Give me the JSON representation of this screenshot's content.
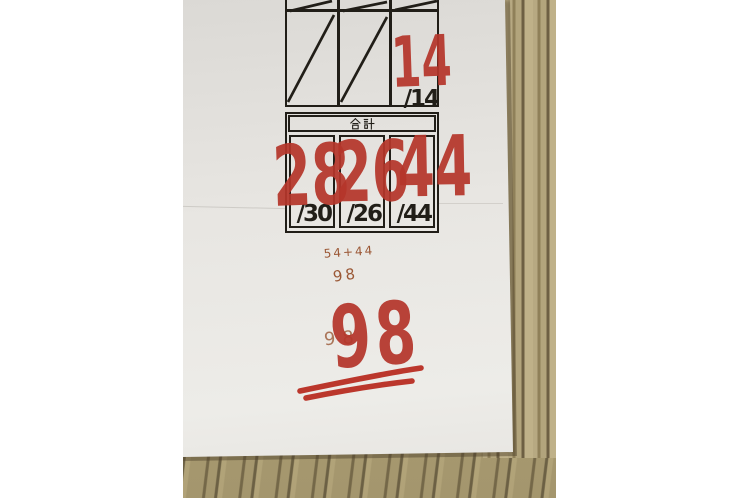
{
  "scene": {
    "description": "Photograph of a graded paper score sheet lying on a wooden desk, white margins left and right",
    "background": "#ffffff"
  },
  "colors": {
    "ink": "#211e18",
    "marker": "#b5362b",
    "pen": "#9b5836",
    "paper": "#e8e6e2",
    "wood": "#b2a37c"
  },
  "table": {
    "header_label": "合計",
    "cutoff_row": {
      "cells": [
        {
          "mark": "diagonal-slash"
        },
        {
          "mark": "diagonal-slash"
        },
        {
          "mark": "diagonal-slash"
        }
      ]
    },
    "top_row": {
      "cells": [
        {
          "score": "",
          "max": "",
          "mark": "diagonal-slash"
        },
        {
          "score": "",
          "max": "",
          "mark": "diagonal-slash"
        },
        {
          "score": "14",
          "max": "/14",
          "mark": "none"
        }
      ]
    },
    "total_row": {
      "cells": [
        {
          "score": "28",
          "max": "/30"
        },
        {
          "score": "26",
          "max": "/26"
        },
        {
          "score": "44",
          "max": "/44"
        }
      ]
    }
  },
  "annotations": {
    "calc_note": "54+44",
    "calc_result": "98",
    "pen_total": "98",
    "final_total": "98"
  }
}
